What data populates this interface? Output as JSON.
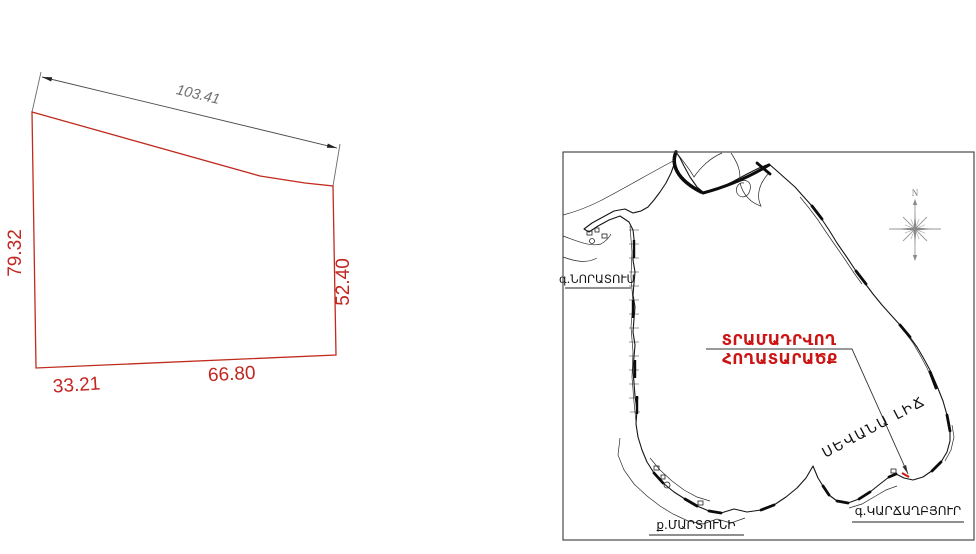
{
  "colors": {
    "parcel_line": "#bf2b1d",
    "dimension_red": "#c32620",
    "annotation_red": "#cc1414",
    "map_line": "#151515",
    "dim_gray": "#6e6e6e"
  },
  "parcel": {
    "dim_top": "103.41",
    "dim_left": "79.32",
    "dim_right": "52.40",
    "dim_bottom_left": "33.21",
    "dim_bottom_right": "66.80"
  },
  "map": {
    "annotation": {
      "line1": "ՏՐԱՄԱԴՐՎՈՂ",
      "line2": "ՀՈՂԱՏԱՐԱԾՔ"
    },
    "lake_label": "ՍԵՎԱՆԱ ԼԻՃ",
    "settlements": {
      "noratus": "գ.ՆՈՐԱՏՈՒՍ",
      "martuni": "ք.ՄԱՐՏՈՒՆԻ",
      "karchaghbyur": "գ.ԿԱՐՃԱՂԲՅՈՒՐ"
    },
    "compass_label": "N"
  }
}
